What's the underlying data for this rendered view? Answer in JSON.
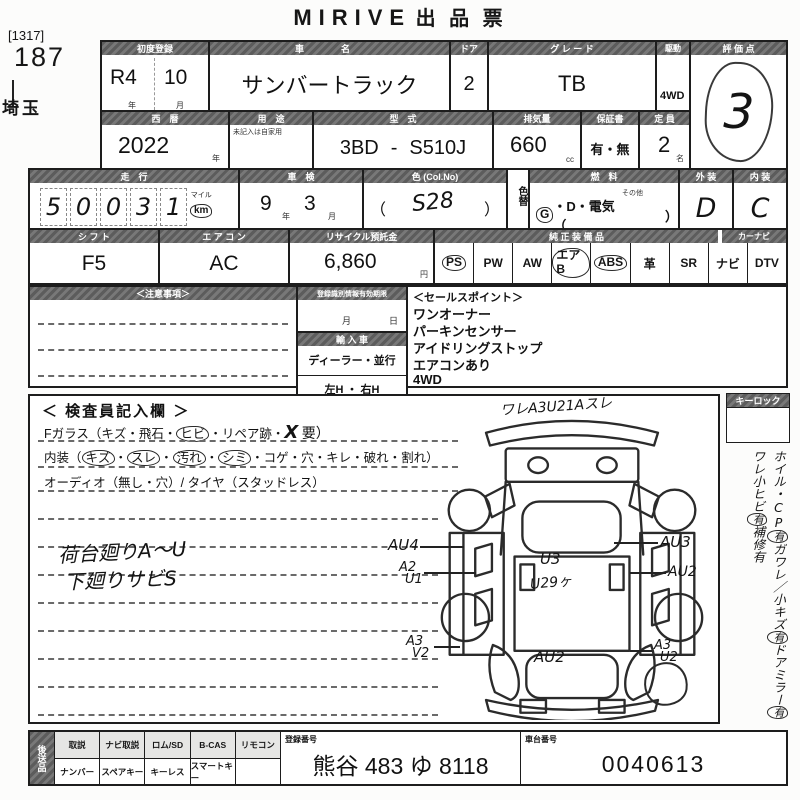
{
  "title": {
    "en": "MIRIVE",
    "jp": "出 品 票"
  },
  "meta": {
    "bracket": "[1317]",
    "lot": "187",
    "pref": "埼玉"
  },
  "r1": {
    "first_reg_label": "初度登録",
    "first_reg_era": "R4",
    "first_reg_month": "10",
    "unit_year": "年",
    "unit_month": "月",
    "name_label": "車　名",
    "name": "サンバートラック",
    "door_label": "ドア",
    "door": "2",
    "grade_label": "グ レ ー ド",
    "grade": "TB",
    "drive_label": "駆動",
    "drive": "4WD",
    "score_label": "評 価 点",
    "score": "3"
  },
  "r2": {
    "year_label": "西　暦",
    "year": "2022",
    "unit_year": "年",
    "use_label": "用　途",
    "use_note": "未記入は自家用",
    "model_label": "型　式",
    "model_prefix": "3BD",
    "model_dash": "-",
    "model": "S510J",
    "disp_label": "排気量",
    "disp": "660",
    "unit_cc": "cc",
    "warranty_label": "保証書",
    "warranty": "有・無",
    "cap_label": "定 員",
    "cap": "2",
    "unit_name": "名"
  },
  "r3": {
    "mileage_label": "走　行",
    "digits": [
      "5",
      "0",
      "0",
      "3",
      "1"
    ],
    "mile": "マイル",
    "km": "km",
    "shaken_label": "車　検",
    "shaken_year": "9",
    "unit_year": "年",
    "shaken_month": "3",
    "unit_month": "月",
    "color_label": "色 (Col.No)",
    "paren_open": "（",
    "color": "S28",
    "paren_close": "）",
    "color_change": "色替",
    "fuel_label": "燃　料",
    "fuel_g": "G",
    "fuel_mid": "・D・電気（",
    "fuel_other": "その他",
    "fuel_close": "）",
    "ext_label": "外 装",
    "ext": "D",
    "int_label": "内 装",
    "int": "C"
  },
  "r4": {
    "shift_label": "シ フ ト",
    "shift": "F5",
    "ac_label": "エ ア コ ン",
    "ac": "AC",
    "recycle_label": "リサイクル預託金",
    "recycle": "6,860",
    "unit_yen": "円",
    "equip_label": "純 正 装 備 品",
    "equip_label2": "カーナビ",
    "equip": [
      "PS",
      "PW",
      "AW",
      "エアB",
      "ABS",
      "革",
      "SR",
      "ナビ",
      "DTV"
    ]
  },
  "mid": {
    "notes_label": "＜注意事項＞",
    "regid_label": "登録識別情報有効期限",
    "unit_month": "月",
    "unit_day": "日",
    "import_label": "輸 入 車",
    "import_type": "ディーラー・並行",
    "import_handle": "左H ・ 右H",
    "sales_label": "＜セールスポイント＞",
    "sales": [
      "ワンオーナー",
      "パーキンセンサー",
      "アイドリングストップ",
      "エアコンあり",
      "4WD"
    ]
  },
  "insp": {
    "title": "＜ 検査員記入欄 ＞",
    "g0": "Fガラス（キズ・飛石・",
    "g1": "ヒビ",
    "g2": "・リペア跡・",
    "g3": "X",
    "g4": "要）",
    "n0": "内装（",
    "n1": "キズ",
    "n2": "・",
    "n3": "スレ",
    "n4": "・",
    "n5": "汚れ",
    "n6": "・",
    "n7": "シミ",
    "n8": "・コゲ・穴・キレ・破れ・割れ）",
    "audio": "オーディオ（無し・穴）/ タイヤ（スタッドレス）",
    "hand1": "荷台廻りA〜U",
    "hand2": "下廻りサビS"
  },
  "diag": {
    "top": "ワレA3U21Aスレ",
    "l1": "AU4",
    "l2a": "A2",
    "l2b": "U1",
    "l3a": "A3",
    "l3b": "V2",
    "r1": "AU3",
    "r2": "AU2",
    "r3a": "A3",
    "r3b": "U2",
    "bed1": "U3",
    "bed2": "U29ヶ",
    "bottom": "AU2"
  },
  "side": {
    "keylock": "キーロック",
    "s0": "ホイル・CP",
    "s1": "有",
    "s2": "ガワレ／",
    "s3": "小キズ",
    "s4": "有",
    "s5": "ドアミラー",
    "s6": "有",
    "s7": "ワレ",
    "s8": "小ヒビ",
    "s9": "有",
    "s10": "補修有"
  },
  "bottom": {
    "send_label": "後送品",
    "rowA": [
      "取説",
      "ナビ取説",
      "ロム/SD",
      "B-CAS",
      "リモコン"
    ],
    "rowB": [
      "ナンバー",
      "スペアキー",
      "キーレス",
      "スマートキー"
    ],
    "reg_label": "登録番号",
    "reg_no": "熊谷 483 ゆ 8118",
    "chassis_label": "車台番号",
    "chassis_no": "0040613"
  }
}
